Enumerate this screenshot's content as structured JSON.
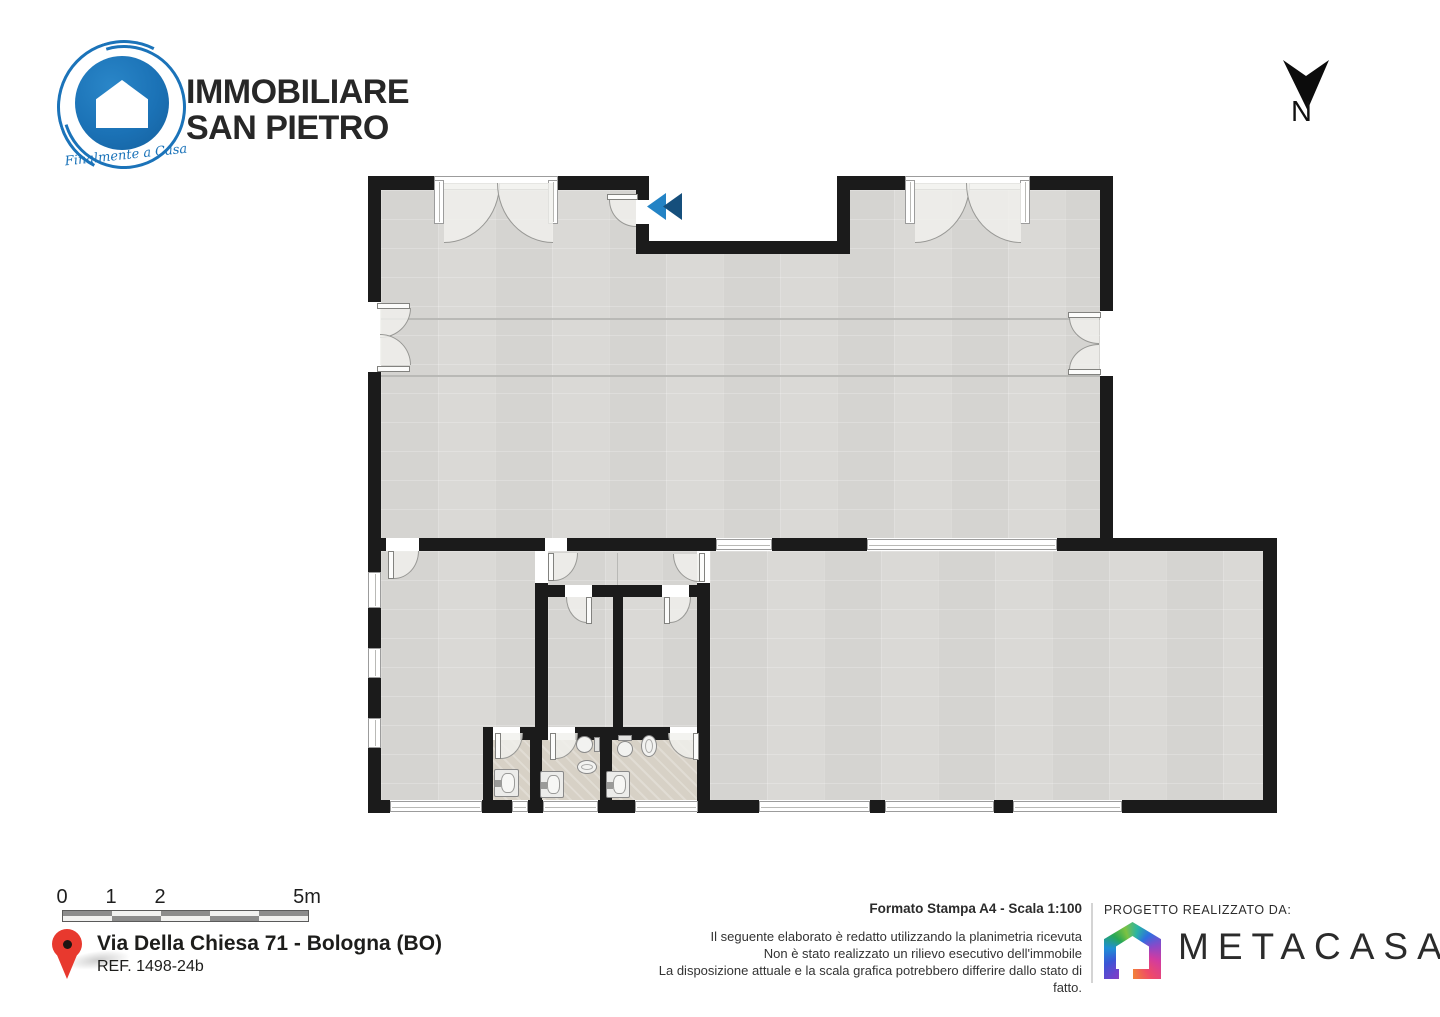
{
  "header": {
    "brand_line1": "IMMOBILIARE",
    "brand_line2": "SAN PIETRO",
    "brand_tagline": "Finalmente a Casa",
    "north_label": "N"
  },
  "footer": {
    "scale_bar": {
      "labels": [
        "0",
        "1",
        "2",
        "5m"
      ],
      "label_positions": [
        62,
        111,
        160,
        307
      ],
      "segments_top": [
        "dark",
        "light",
        "dark",
        "light",
        "dark"
      ],
      "segments_bottom": [
        "light",
        "dark",
        "light",
        "dark",
        "light"
      ]
    },
    "address_line1": "Via Della Chiesa 71 - Bologna (BO)",
    "address_line2": "REF. 1498-24b",
    "print_info": "Formato Stampa A4 - Scala 1:100",
    "disclaimer": [
      "Il seguente elaborato è redatto utilizzando la planimetria ricevuta",
      "Non è stato realizzato un rilievo esecutivo dell'immobile",
      "La disposizione attuale e la scala grafica potrebbero differire dallo stato di fatto."
    ],
    "credit_label": "PROGETTO REALIZZATO DA:",
    "credit_brand": "METACASA"
  },
  "colors": {
    "wall": "#1b1b1b",
    "floor": "#d9d8d5",
    "bath_floor": "#d7d1c6",
    "brand_blue": "#1b73b9",
    "chevron_light": "#2383c5",
    "chevron_dark": "#154f7c",
    "pin_red": "#e8392e"
  },
  "floorplan": {
    "floors": [
      {
        "n": "floor-room-top",
        "t": "tile",
        "x": 381,
        "y": 190,
        "w": 719,
        "h": 348
      },
      {
        "n": "outside-entrance-notch",
        "t": "white",
        "x": 649,
        "y": 176,
        "w": 188,
        "h": 65
      },
      {
        "n": "floor-room-bottom-left",
        "t": "tile",
        "x": 381,
        "y": 551,
        "w": 154,
        "h": 249
      },
      {
        "n": "floor-vestibule-and-wc",
        "t": "tile",
        "x": 548,
        "y": 551,
        "w": 149,
        "h": 176
      },
      {
        "n": "floor-room-bottom-right",
        "t": "tile",
        "x": 710,
        "y": 551,
        "w": 553,
        "h": 249
      },
      {
        "n": "floor-bathrooms",
        "t": "bath",
        "x": 493,
        "y": 740,
        "w": 204,
        "h": 60
      }
    ],
    "lines": [
      [
        "band-line-upper",
        381,
        318,
        719,
        2
      ],
      [
        "band-line-lower",
        381,
        375,
        719,
        2
      ],
      [
        "vestibule-divider",
        617,
        553,
        1,
        32
      ]
    ],
    "walls": [
      [
        "top-wall-l1",
        368,
        176,
        66,
        14
      ],
      [
        "top-wall-l2",
        558,
        176,
        91,
        14
      ],
      [
        "notch-wall-left-a",
        636,
        190,
        13,
        12
      ],
      [
        "notch-wall-left-b",
        636,
        222,
        13,
        32
      ],
      [
        "notch-wall-bottom",
        636,
        241,
        214,
        13
      ],
      [
        "notch-wall-right",
        837,
        190,
        13,
        51
      ],
      [
        "top-wall-r1",
        837,
        176,
        68,
        14
      ],
      [
        "top-wall-r2",
        1030,
        176,
        83,
        14
      ],
      [
        "left-wall-a",
        368,
        176,
        13,
        126
      ],
      [
        "left-wall-b",
        368,
        372,
        13,
        179
      ],
      [
        "right-wall-a",
        1100,
        176,
        13,
        135
      ],
      [
        "right-wall-b",
        1100,
        376,
        13,
        162
      ],
      [
        "mid-wall-a",
        368,
        538,
        18,
        13
      ],
      [
        "mid-wall-b",
        419,
        538,
        126,
        13
      ],
      [
        "mid-wall-c",
        567,
        538,
        149,
        13
      ],
      [
        "mid-wall-d",
        772,
        538,
        95,
        13
      ],
      [
        "mid-wall-e",
        1057,
        538,
        220,
        13
      ],
      [
        "left-wall-c",
        368,
        551,
        13,
        21
      ],
      [
        "left-wall-d",
        368,
        608,
        13,
        40
      ],
      [
        "left-wall-e",
        368,
        678,
        13,
        40
      ],
      [
        "left-wall-f",
        368,
        748,
        13,
        65
      ],
      [
        "bottom-wall-a",
        368,
        800,
        22,
        13
      ],
      [
        "bottom-wall-b",
        482,
        800,
        30,
        13
      ],
      [
        "bottom-wall-c",
        528,
        800,
        15,
        13
      ],
      [
        "bottom-wall-d",
        598,
        800,
        37,
        13
      ],
      [
        "bottom-wall-e",
        698,
        800,
        61,
        13
      ],
      [
        "bottom-wall-f",
        870,
        800,
        15,
        13
      ],
      [
        "bottom-wall-g",
        994,
        800,
        19,
        13
      ],
      [
        "bottom-wall-h",
        1122,
        800,
        155,
        13
      ],
      [
        "right-wall-lower",
        1263,
        551,
        14,
        262
      ],
      [
        "wc-west-wall",
        535,
        583,
        13,
        144
      ],
      [
        "wc-north-wall-a",
        535,
        585,
        30,
        12
      ],
      [
        "wc-north-wall-b",
        592,
        585,
        70,
        12
      ],
      [
        "wc-north-wall-c",
        689,
        585,
        21,
        12
      ],
      [
        "wc-middle-wall",
        613,
        585,
        10,
        142
      ],
      [
        "wc-east-wall-a",
        697,
        583,
        13,
        144
      ],
      [
        "wc-east-wall-b",
        697,
        727,
        13,
        86
      ],
      [
        "bath-north-wall-a",
        483,
        727,
        10,
        13
      ],
      [
        "bath-north-wall-b",
        520,
        727,
        28,
        13
      ],
      [
        "bath-north-wall-c",
        575,
        727,
        97,
        13
      ],
      [
        "bath-west-wall",
        483,
        727,
        10,
        73
      ],
      [
        "bath-divider-1",
        530,
        740,
        12,
        60
      ],
      [
        "bath-divider-2",
        600,
        740,
        12,
        60
      ]
    ],
    "windows": [
      [
        "window-top-left",
        434,
        176,
        124,
        14
      ],
      [
        "window-top-right",
        905,
        176,
        125,
        14
      ],
      [
        "jamb-top-left-a",
        434,
        180,
        10,
        44
      ],
      [
        "jamb-top-left-b",
        548,
        180,
        10,
        44
      ],
      [
        "jamb-top-right-a",
        905,
        180,
        10,
        44
      ],
      [
        "jamb-top-right-b",
        1020,
        180,
        10,
        44
      ],
      [
        "window-mid-a",
        716,
        539,
        56,
        11
      ],
      [
        "window-mid-b",
        867,
        539,
        190,
        11
      ],
      [
        "window-left-a",
        368,
        572,
        13,
        36
      ],
      [
        "window-left-b",
        368,
        648,
        13,
        30
      ],
      [
        "window-left-c",
        368,
        718,
        13,
        30
      ],
      [
        "window-bottom-a",
        390,
        801,
        92,
        11
      ],
      [
        "window-bottom-b",
        512,
        801,
        16,
        11
      ],
      [
        "window-bottom-c",
        543,
        801,
        55,
        11
      ],
      [
        "window-bottom-d",
        635,
        801,
        63,
        11
      ],
      [
        "window-bottom-e",
        759,
        801,
        111,
        11
      ],
      [
        "window-bottom-f",
        885,
        801,
        109,
        11
      ],
      [
        "window-bottom-g",
        1013,
        801,
        109,
        11
      ]
    ],
    "gaps": [
      [
        "gap-entrance-door",
        636,
        200,
        13,
        24
      ],
      [
        "gap-left-double-door",
        368,
        302,
        13,
        70
      ],
      [
        "gap-right-double-door",
        1100,
        311,
        13,
        65
      ],
      [
        "gap-room-bl-door",
        386,
        538,
        33,
        13
      ],
      [
        "gap-vestibule-door",
        545,
        538,
        22,
        13
      ],
      [
        "gap-vestibule-west",
        535,
        551,
        13,
        32
      ],
      [
        "gap-vestibule-east",
        697,
        552,
        13,
        31
      ],
      [
        "gap-wc-left-door",
        565,
        585,
        27,
        12
      ],
      [
        "gap-wc-right-door",
        662,
        585,
        27,
        12
      ],
      [
        "gap-bath-left-door",
        493,
        727,
        27,
        13
      ],
      [
        "gap-bath-mid-door",
        548,
        727,
        27,
        13
      ],
      [
        "gap-bath-right-door",
        670,
        727,
        27,
        13
      ]
    ],
    "arcs": [
      [
        "arc-window-tl-left",
        444,
        183,
        56,
        60,
        "br"
      ],
      [
        "arc-window-tl-right",
        497,
        183,
        56,
        60,
        "bl"
      ],
      [
        "arc-window-tr-left",
        915,
        183,
        55,
        60,
        "br"
      ],
      [
        "arc-window-tr-right",
        966,
        183,
        55,
        60,
        "bl"
      ],
      [
        "arc-left-dd-top",
        380,
        308,
        31,
        30,
        "br"
      ],
      [
        "arc-left-dd-bottom",
        380,
        334,
        31,
        31,
        "tr"
      ],
      [
        "arc-right-dd-top",
        1069,
        317,
        30,
        27,
        "bl"
      ],
      [
        "arc-right-dd-bottom",
        1069,
        344,
        30,
        26,
        "tl"
      ],
      [
        "arc-entrance",
        609,
        200,
        27,
        27,
        "bl"
      ],
      [
        "arc-room-bl-door",
        394,
        551,
        25,
        28,
        "br"
      ],
      [
        "arc-vestibule-west",
        554,
        553,
        24,
        28,
        "br"
      ],
      [
        "arc-vestibule-east",
        673,
        554,
        26,
        28,
        "bl"
      ],
      [
        "arc-wc-left",
        566,
        597,
        21,
        26,
        "bl"
      ],
      [
        "arc-wc-right",
        670,
        597,
        21,
        26,
        "br"
      ],
      [
        "arc-bath-left",
        501,
        733,
        22,
        26,
        "br"
      ],
      [
        "arc-bath-mid",
        556,
        733,
        22,
        26,
        "br"
      ],
      [
        "arc-bath-right",
        668,
        733,
        25,
        26,
        "bl"
      ]
    ],
    "leaves": [
      [
        "leaf-entrance",
        607,
        194,
        31,
        6
      ],
      [
        "leaf-left-dd-top",
        377,
        303,
        33,
        6
      ],
      [
        "leaf-left-dd-bottom",
        377,
        366,
        33,
        6
      ],
      [
        "leaf-right-dd-top",
        1068,
        312,
        33,
        6
      ],
      [
        "leaf-right-dd-bottom",
        1068,
        369,
        33,
        6
      ],
      [
        "leaf-room-bl",
        388,
        551,
        6,
        28
      ],
      [
        "leaf-vestibule-west",
        548,
        553,
        6,
        28
      ],
      [
        "leaf-vestibule-east",
        699,
        553,
        6,
        29
      ],
      [
        "leaf-wc-left",
        586,
        597,
        6,
        27
      ],
      [
        "leaf-wc-right",
        664,
        597,
        6,
        27
      ],
      [
        "leaf-bath-left",
        495,
        733,
        6,
        26
      ],
      [
        "leaf-bath-mid",
        550,
        733,
        6,
        27
      ],
      [
        "leaf-bath-right",
        693,
        733,
        6,
        27
      ]
    ],
    "fixtures": [
      {
        "t": "sink",
        "n": "sink-left-bath",
        "x": 494,
        "y": 769,
        "w": 25,
        "h": 28
      },
      {
        "t": "sink",
        "n": "sink-mid-bath",
        "x": 540,
        "y": 771,
        "w": 24,
        "h": 27
      },
      {
        "t": "sink",
        "n": "sink-right-bath",
        "x": 606,
        "y": 771,
        "w": 24,
        "h": 27
      },
      {
        "t": "wc-h",
        "n": "toilet-mid-bath",
        "x": 576,
        "y": 736,
        "w": 24,
        "h": 17
      },
      {
        "t": "bidet-h",
        "n": "bidet-mid-bath",
        "x": 577,
        "y": 760,
        "w": 20,
        "h": 14
      },
      {
        "t": "wc-v",
        "n": "toilet-right-bath",
        "x": 617,
        "y": 735,
        "w": 16,
        "h": 22
      },
      {
        "t": "bidet-v",
        "n": "bidet-right-bath",
        "x": 641,
        "y": 735,
        "w": 16,
        "h": 22
      }
    ],
    "chevron": {
      "x": 647,
      "y": 193,
      "w": 19,
      "h": 27,
      "offset": 16
    }
  }
}
